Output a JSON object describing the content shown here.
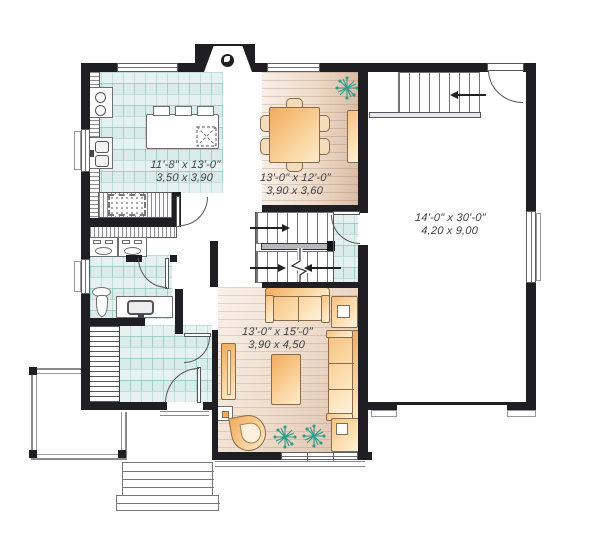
{
  "title": "First floor plan",
  "labels": {
    "kitchen": {
      "imperial": "11'-8\" x 13'-0\"",
      "metric": "3,50 x 3,90"
    },
    "dining": {
      "imperial": "13'-0\" x 12'-0\"",
      "metric": "3,90 x 3,60"
    },
    "garage": {
      "imperial": "14'-0\" x 30'-0\"",
      "metric": "4,20 x 9,00"
    },
    "living": {
      "imperial": "13'-0\" x 15'-0\"",
      "metric": "3,90 x 4,50"
    }
  },
  "colors": {
    "wall": "#1f1f23",
    "tile_floor": "#d9ece8",
    "tile_grid": "#86c0b7",
    "wood_light": "#f7efe7",
    "wood_dark": "#d9bda7",
    "furniture_accent": "#f3ab5e",
    "plant_green": "#2e9b8a",
    "label_text": "#3e3e47"
  },
  "fixtures": [
    "chimney",
    "kitchen-island",
    "stove",
    "double-sink",
    "pantry",
    "dishwasher",
    "washer",
    "dryer",
    "toilet",
    "vanity-sink",
    "coat-closet",
    "dining-table",
    "buffet",
    "loveseat",
    "sofa",
    "coffee-table",
    "console-table",
    "armchair",
    "corner-desk",
    "side-table",
    "plants",
    "main-stairs",
    "garage-stairs",
    "porch",
    "front-steps"
  ]
}
